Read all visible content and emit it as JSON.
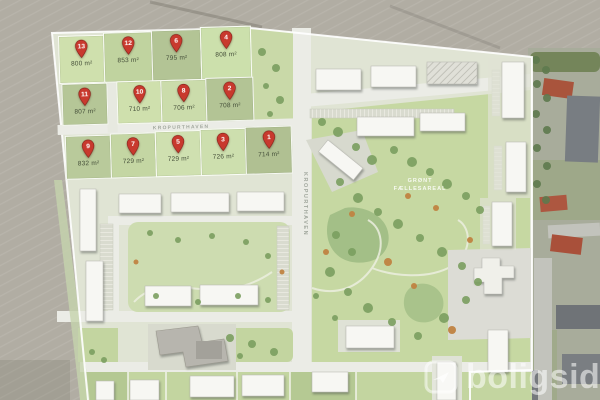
{
  "site_plan": {
    "streets": {
      "main_road": "KROPURTHAVEN",
      "side_road": "KROPURTHAVEN"
    },
    "common_area": {
      "label_line1": "GRØNT",
      "label_line2": "FÆLLESAREAL"
    },
    "watermark": {
      "brand": "boligsiden"
    },
    "colors": {
      "pin": "#c8392e",
      "pin_border": "#7e1d14"
    },
    "plots": [
      {
        "pin": "13",
        "area": "800 m²",
        "x": 58,
        "y": 36,
        "w": 44,
        "h": 46,
        "fill": "#cfe0ad"
      },
      {
        "pin": "12",
        "area": "853 m²",
        "x": 103,
        "y": 34,
        "w": 47,
        "h": 48,
        "fill": "#c0d39f"
      },
      {
        "pin": "6",
        "area": "795 m²",
        "x": 151,
        "y": 33,
        "w": 48,
        "h": 49,
        "fill": "#b3c495"
      },
      {
        "pin": "4",
        "area": "808 m²",
        "x": 200,
        "y": 31,
        "w": 49,
        "h": 51,
        "fill": "#cce0ac"
      },
      {
        "pin": "11",
        "area": "807 m²",
        "x": 60,
        "y": 84,
        "w": 44,
        "h": 40,
        "fill": "#b5c697"
      },
      {
        "pin": "10",
        "area": "710 m²",
        "x": 115,
        "y": 83,
        "w": 43,
        "h": 41,
        "fill": "#cfe0ad"
      },
      {
        "pin": "8",
        "area": "706 m²",
        "x": 159,
        "y": 83,
        "w": 44,
        "h": 41,
        "fill": "#cbdcab"
      },
      {
        "pin": "2",
        "area": "708 m²",
        "x": 204,
        "y": 82,
        "w": 46,
        "h": 42,
        "fill": "#b3c495"
      },
      {
        "pin": "9",
        "area": "832 m²",
        "x": 62,
        "y": 136,
        "w": 44,
        "h": 42,
        "fill": "#b9ca9b"
      },
      {
        "pin": "7",
        "area": "729 m²",
        "x": 107,
        "y": 135,
        "w": 44,
        "h": 43,
        "fill": "#c4d6a3"
      },
      {
        "pin": "5",
        "area": "729 m²",
        "x": 152,
        "y": 134,
        "w": 44,
        "h": 44,
        "fill": "#cfe0b0"
      },
      {
        "pin": "3",
        "area": "726 m²",
        "x": 197,
        "y": 133,
        "w": 44,
        "h": 45,
        "fill": "#cddfae"
      },
      {
        "pin": "1",
        "area": "714 m²",
        "x": 242,
        "y": 132,
        "w": 45,
        "h": 46,
        "fill": "#b0c092"
      }
    ]
  }
}
